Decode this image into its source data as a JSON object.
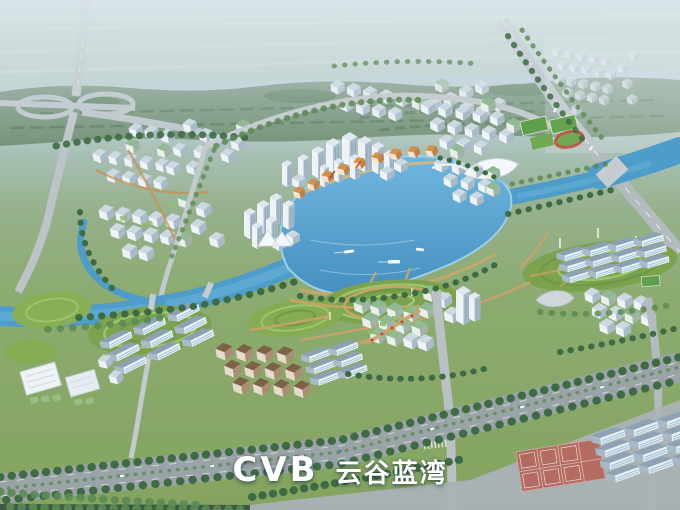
{
  "logo": {
    "latin": "CVB",
    "chinese": "云谷蓝湾"
  },
  "palette": {
    "sky_top": "#cbdae2",
    "sky_low": "#b7cad2",
    "farmland": "#b7cbc0",
    "belt_green": "#6b8a6e",
    "tree_dark": "#3f6b44",
    "tree_mid": "#5c8a54",
    "park_green": "#8fae63",
    "hill_green": "#7da24f",
    "water_deep": "#4e9cc9",
    "water_light": "#7fc2e4",
    "road_gray": "#bcc4c8",
    "boulevard_gray": "#9aa3a7",
    "path_tan": "#c9a368",
    "building_white": "#eef3f7",
    "building_shade": "#a9bac8",
    "roof_blue": "#8ca2b4",
    "roof_green": "#8fba93",
    "roof_orange": "#d29048",
    "roof_brown": "#7d6148",
    "track_red": "#bf5a48",
    "court_red": "#b5655c",
    "logo_white": "#ffffff"
  }
}
